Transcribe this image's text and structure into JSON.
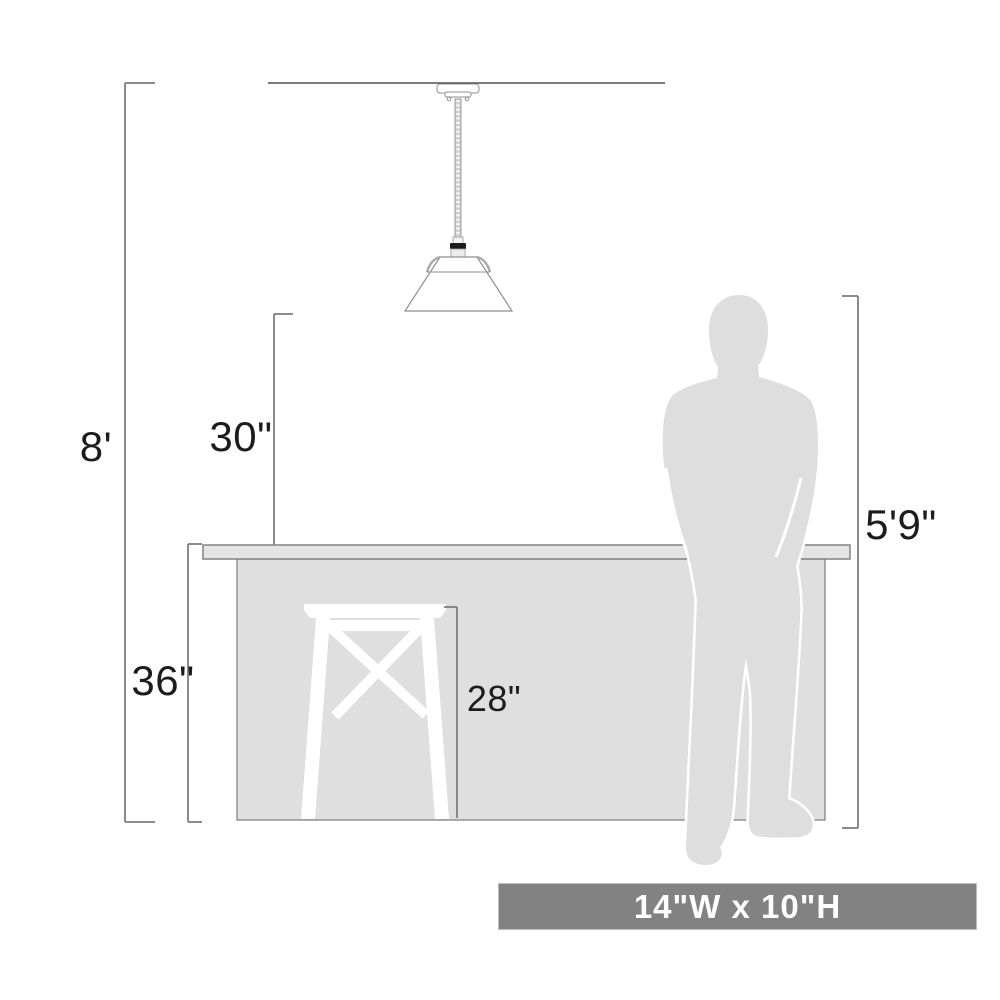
{
  "labels": {
    "ceiling_height": "8'",
    "shade_to_counter": "30\"",
    "counter_height": "36\"",
    "stool_height": "28\"",
    "person_height": "5'9\"",
    "fixture_size": "14\"W x 10\"H"
  },
  "figures": {
    "pendant": "cone-shade-pendant-light",
    "person": "man-silhouette",
    "stool": "bar-stool-silhouette",
    "counter": "kitchen-island-with-countertop"
  },
  "colors": {
    "background": "#ffffff",
    "silhouette_gray": "#dedede",
    "counter_fill": "#dfdfe0",
    "countertop_fill": "#e4e4e5",
    "outline_gray": "#7a7a7a",
    "ceiling_line": "#4f4f4f",
    "label_text": "#1c1c1c",
    "badge_background": "#828282",
    "badge_text": "#ffffff",
    "socket_black": "#1b1b1b"
  }
}
